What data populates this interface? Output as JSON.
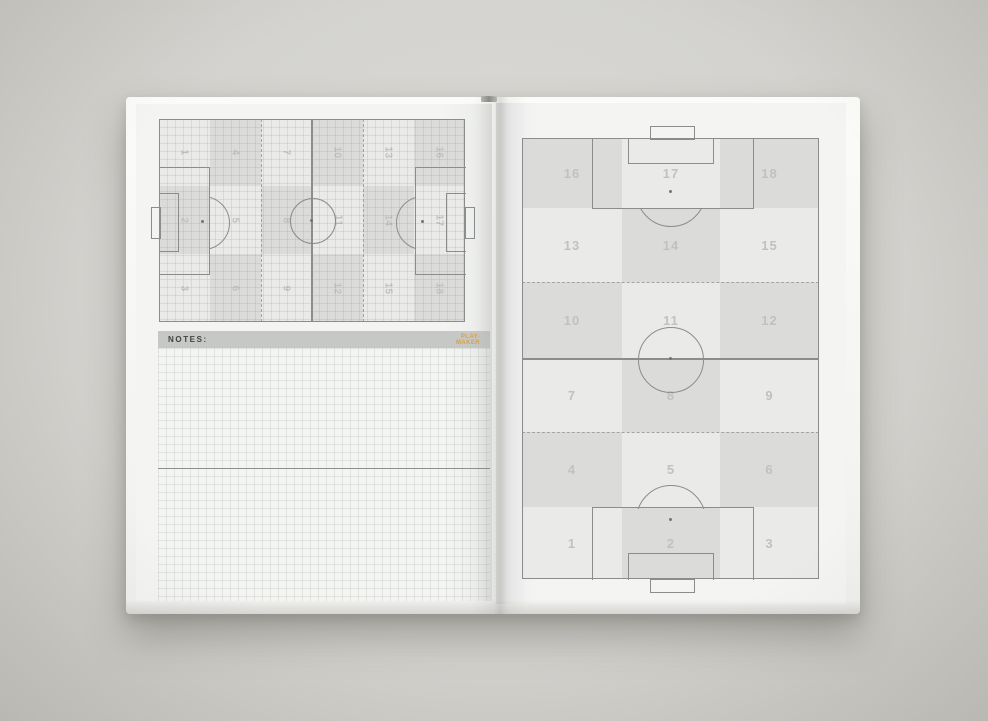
{
  "notes": {
    "label": "NOTES:",
    "logo_line1": "PLAY-",
    "logo_line2": "MAKER"
  },
  "left_pitch": {
    "orientation": "landscape",
    "zones": [
      {
        "n": "1",
        "col": 0,
        "row": 0,
        "shade": "light"
      },
      {
        "n": "2",
        "col": 0,
        "row": 1,
        "shade": "dark"
      },
      {
        "n": "3",
        "col": 0,
        "row": 2,
        "shade": "light"
      },
      {
        "n": "4",
        "col": 1,
        "row": 0,
        "shade": "dark"
      },
      {
        "n": "5",
        "col": 1,
        "row": 1,
        "shade": "light"
      },
      {
        "n": "6",
        "col": 1,
        "row": 2,
        "shade": "dark"
      },
      {
        "n": "7",
        "col": 2,
        "row": 0,
        "shade": "light"
      },
      {
        "n": "8",
        "col": 2,
        "row": 1,
        "shade": "dark"
      },
      {
        "n": "9",
        "col": 2,
        "row": 2,
        "shade": "light"
      },
      {
        "n": "10",
        "col": 3,
        "row": 0,
        "shade": "dark"
      },
      {
        "n": "11",
        "col": 3,
        "row": 1,
        "shade": "light"
      },
      {
        "n": "12",
        "col": 3,
        "row": 2,
        "shade": "dark"
      },
      {
        "n": "13",
        "col": 4,
        "row": 0,
        "shade": "light"
      },
      {
        "n": "14",
        "col": 4,
        "row": 1,
        "shade": "dark"
      },
      {
        "n": "15",
        "col": 4,
        "row": 2,
        "shade": "light"
      },
      {
        "n": "16",
        "col": 5,
        "row": 0,
        "shade": "dark"
      },
      {
        "n": "17",
        "col": 5,
        "row": 1,
        "shade": "light"
      },
      {
        "n": "18",
        "col": 5,
        "row": 2,
        "shade": "dark"
      }
    ]
  },
  "right_pitch": {
    "orientation": "portrait",
    "zones": [
      {
        "n": "16",
        "col": 0,
        "row": 0,
        "shade": "dark"
      },
      {
        "n": "17",
        "col": 1,
        "row": 0,
        "shade": "light"
      },
      {
        "n": "18",
        "col": 2,
        "row": 0,
        "shade": "dark"
      },
      {
        "n": "13",
        "col": 0,
        "row": 1,
        "shade": "light"
      },
      {
        "n": "14",
        "col": 1,
        "row": 1,
        "shade": "dark"
      },
      {
        "n": "15",
        "col": 2,
        "row": 1,
        "shade": "light"
      },
      {
        "n": "10",
        "col": 0,
        "row": 2,
        "shade": "dark"
      },
      {
        "n": "11",
        "col": 1,
        "row": 2,
        "shade": "light"
      },
      {
        "n": "12",
        "col": 2,
        "row": 2,
        "shade": "dark"
      },
      {
        "n": "7",
        "col": 0,
        "row": 3,
        "shade": "light"
      },
      {
        "n": "8",
        "col": 1,
        "row": 3,
        "shade": "dark"
      },
      {
        "n": "9",
        "col": 2,
        "row": 3,
        "shade": "light"
      },
      {
        "n": "4",
        "col": 0,
        "row": 4,
        "shade": "dark"
      },
      {
        "n": "5",
        "col": 1,
        "row": 4,
        "shade": "light"
      },
      {
        "n": "6",
        "col": 2,
        "row": 4,
        "shade": "dark"
      },
      {
        "n": "1",
        "col": 0,
        "row": 5,
        "shade": "light"
      },
      {
        "n": "2",
        "col": 1,
        "row": 5,
        "shade": "dark"
      },
      {
        "n": "3",
        "col": 2,
        "row": 5,
        "shade": "light"
      }
    ]
  },
  "colors": {
    "zone_dark": "#dbdcda",
    "zone_light": "#eaebe9",
    "pitch_line": "#8a8c8e",
    "zone_number": "#bfc2bf",
    "notes_bar": "#c6c8c6",
    "accent_orange": "#d8a14b",
    "page": "#f3f4f2",
    "bg": "#d3d2ce"
  }
}
